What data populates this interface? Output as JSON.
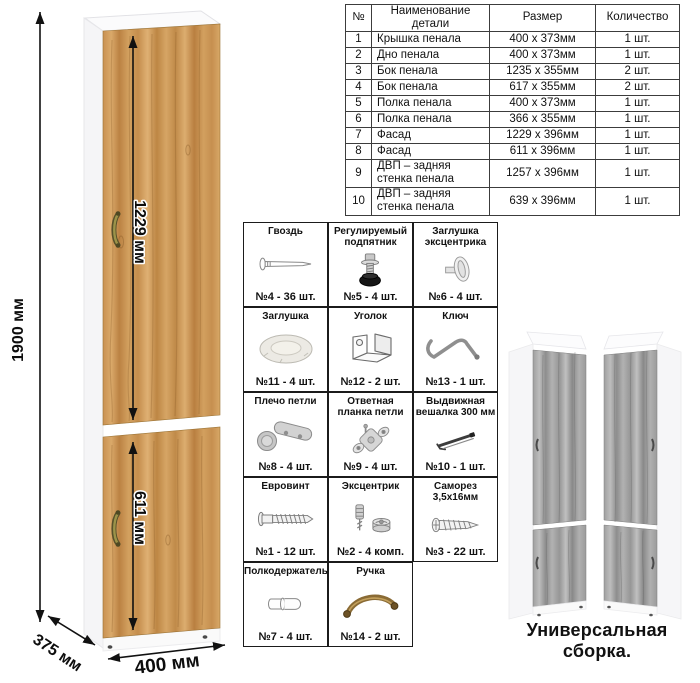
{
  "parts_table": {
    "headers": [
      "№",
      "Наименование детали",
      "Размер",
      "Количество"
    ],
    "rows": [
      [
        "1",
        "Крышка пенала",
        "400 х 373мм",
        "1 шт."
      ],
      [
        "2",
        "Дно пенала",
        "400 х 373мм",
        "1 шт."
      ],
      [
        "3",
        "Бок пенала",
        "1235 х 355мм",
        "2 шт."
      ],
      [
        "4",
        "Бок пенала",
        "617 х 355мм",
        "2 шт."
      ],
      [
        "5",
        "Полка пенала",
        "400 х 373мм",
        "1 шт."
      ],
      [
        "6",
        "Полка пенала",
        "366 х 355мм",
        "1 шт."
      ],
      [
        "7",
        "Фасад",
        "1229 х 396мм",
        "1 шт."
      ],
      [
        "8",
        "Фасад",
        "611 х 396мм",
        "1 шт."
      ],
      [
        "9",
        "ДВП – задняя стенка пенала",
        "1257 х 396мм",
        "1 шт."
      ],
      [
        "10",
        "ДВП – задняя стенка пенала",
        "639 х 396мм",
        "1 шт."
      ]
    ]
  },
  "hardware": {
    "items": [
      {
        "title": "Гвоздь",
        "count": "№4 - 36 шт.",
        "icon": "nail-icon"
      },
      {
        "title": "Регулируемый подпятник",
        "count": "№5 - 4 шт.",
        "icon": "adjustable-foot-icon"
      },
      {
        "title": "Заглушка эксцентрика",
        "count": "№6 - 4 шт.",
        "icon": "cam-cover-icon"
      },
      {
        "title": "Заглушка",
        "count": "№11 - 4 шт.",
        "icon": "cap-icon"
      },
      {
        "title": "Уголок",
        "count": "№12 - 2 шт.",
        "icon": "corner-bracket-icon"
      },
      {
        "title": "Ключ",
        "count": "№13 - 1 шт.",
        "icon": "key-icon"
      },
      {
        "title": "Плечо петли",
        "count": "№8 - 4 шт.",
        "icon": "hinge-arm-icon"
      },
      {
        "title": "Ответная планка петли",
        "count": "№9 - 4 шт.",
        "icon": "hinge-plate-icon"
      },
      {
        "title": "Выдвижная вешалка 300 мм",
        "count": "№10 - 1 шт.",
        "icon": "pullout-hanger-icon"
      },
      {
        "title": "Евровинт",
        "count": "№1 - 12 шт.",
        "icon": "confirmat-screw-icon"
      },
      {
        "title": "Эксцентрик",
        "count": "№2 - 4 комп.",
        "icon": "cam-lock-icon"
      },
      {
        "title": "Саморез 3,5х16мм",
        "count": "№3 - 22 шт.",
        "icon": "self-tapping-screw-icon"
      },
      {
        "title": "Полкодержатель",
        "count": "№7 - 4 шт.",
        "icon": "shelf-pin-icon"
      },
      {
        "title": "Ручка",
        "count": "№14 - 2 шт.",
        "icon": "handle-icon"
      }
    ]
  },
  "dimensions": {
    "height": "1900 мм",
    "upper_door": "1229 мм",
    "lower_door": "611 мм",
    "width": "400 мм",
    "depth": "375 мм"
  },
  "variants": {
    "caption": "Универсальная сборка."
  },
  "colors": {
    "wood_light": "#d8a767",
    "wood_dark": "#b67f41",
    "gray_wood_light": "#b5b5b5",
    "gray_wood_dark": "#8d8d8d",
    "handle_bronze": "#8a8040",
    "carcass_white": "#f6f6f8"
  }
}
